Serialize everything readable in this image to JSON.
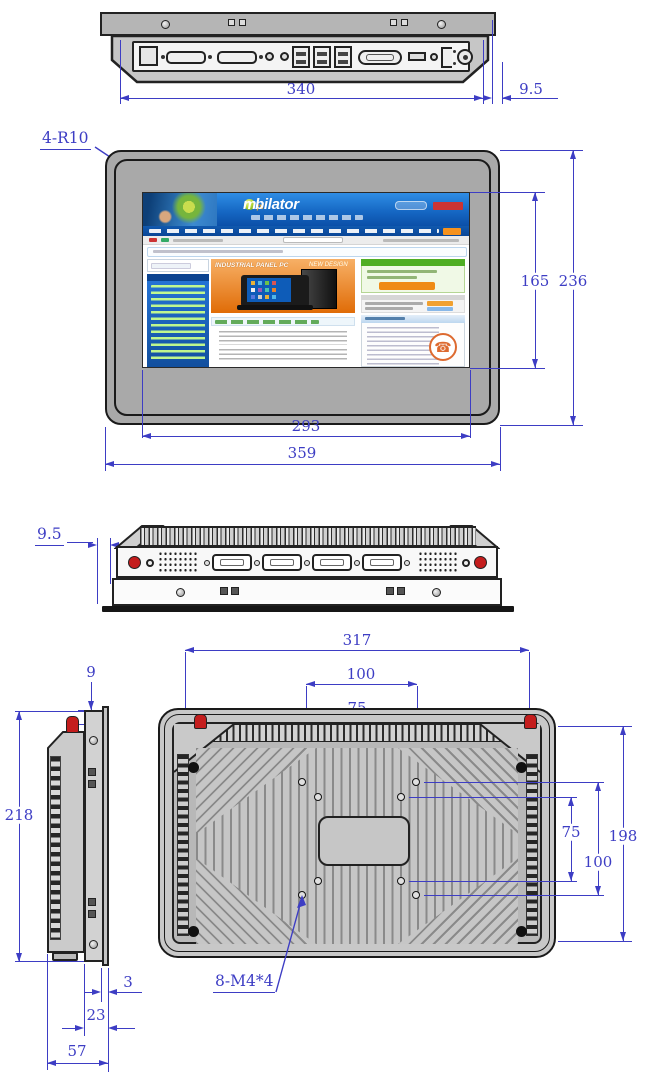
{
  "colors": {
    "dimension_blue": "#3d3dc4",
    "outline_dark": "#1f1f1f",
    "body_gray": "#b5b5b5",
    "accent_red": "#c41d1d",
    "web_header_blue": "#1668c4",
    "web_banner_orange": "#e8720c"
  },
  "top_view": {
    "dim_width": "340",
    "dim_bezel_offset": "9.5"
  },
  "front_view": {
    "corner_radius_label": "4-R10",
    "dim_screen_height": "165",
    "dim_height": "236",
    "dim_screen_width": "293",
    "dim_width": "359",
    "webpage": {
      "logo_m": "m",
      "logo_rest": "bilator",
      "logo_tld": ".pl",
      "banner_title": "INDUSTRIAL PANEL PC",
      "banner_badge": "NEW DESIGN"
    }
  },
  "bottom_view": {
    "dim_bezel_offset": "9.5"
  },
  "rear_section": {
    "dim_mount_width": "317",
    "dim_vesa100_h": "100",
    "dim_vesa75_h": "75",
    "dim_flange_lip": "9",
    "dim_side_height": "218",
    "dim_vesa75_v": "75",
    "dim_vesa100_v": "100",
    "dim_mount_height": "198",
    "mount_holes_label": "8-M4*4",
    "dim_lip_thickness": "3",
    "dim_body_depth": "23",
    "dim_total_depth": "57"
  }
}
